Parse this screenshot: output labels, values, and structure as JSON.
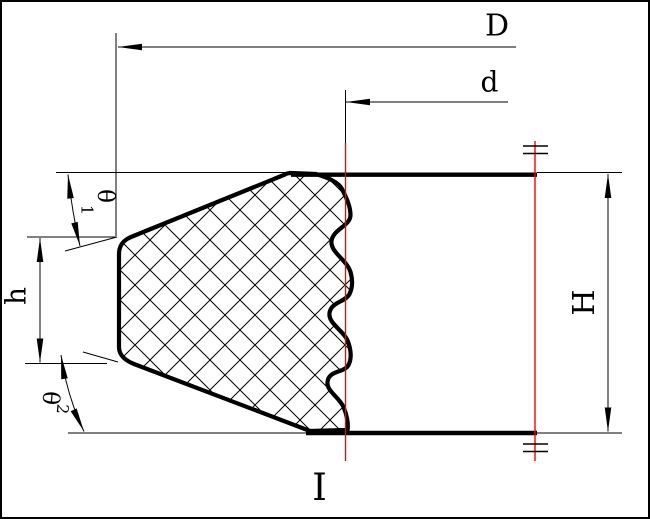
{
  "drawing": {
    "type": "engineering-cross-section",
    "background": "#ffffff",
    "line_color": "#000000",
    "centerline_color": "#fe0000",
    "dimensions": {
      "outer_diameter": {
        "label": "D"
      },
      "inner_diameter": {
        "label": "d"
      },
      "total_height": {
        "label": "H"
      },
      "lip_height": {
        "label": "h"
      },
      "angle_top": {
        "symbol": "θ",
        "subscript": "1"
      },
      "angle_bottom": {
        "symbol": "θ",
        "subscript": "2"
      },
      "section_mark": {
        "label": "I"
      }
    }
  }
}
